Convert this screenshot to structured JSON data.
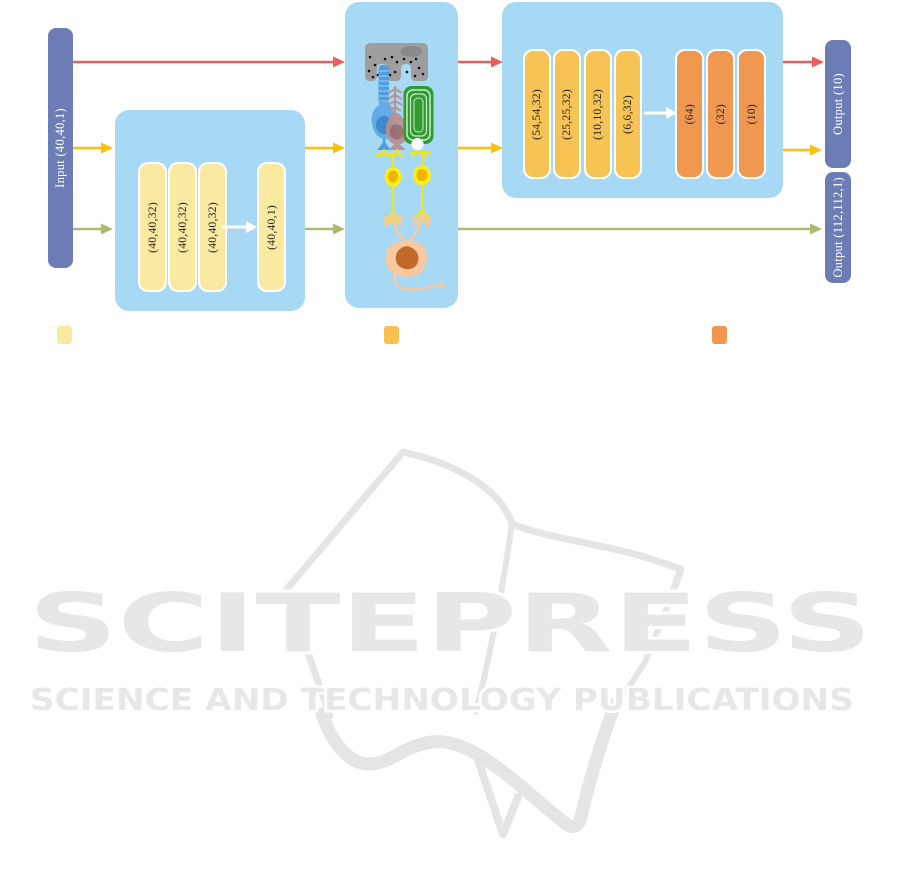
{
  "figure": {
    "type": "neural-network-architecture-diagram",
    "background": "#ffffff"
  },
  "diagram": {
    "input": {
      "label": "Input (40,40,1)"
    },
    "outputs": [
      {
        "label": "Output (10)"
      },
      {
        "label": "Output (112,112,1)"
      }
    ],
    "sae_branch": {
      "layers": [
        "(40,40,32)",
        "(40,40,32)",
        "(40,40,32)",
        "(40,40,1)"
      ]
    },
    "cnn_branch": {
      "conv_layers": [
        "(54,54,32)",
        "(25,25,32)",
        "(10,10,32)",
        "(6,6,32)"
      ],
      "dense_layers": [
        "(64)",
        "(32)",
        "(10)"
      ]
    },
    "colors": {
      "group_box": "#A7D9F5",
      "io_bar": "#6C7DB6",
      "layer_light_yellow": "#FAE9A1",
      "layer_amber": "#F8C355",
      "layer_orange": "#F0984F",
      "arrow_red": "#EC5C5C",
      "arrow_yellow": "#FDC00D",
      "arrow_olive": "#AEB96F",
      "arrow_white": "#FFFFFF"
    }
  },
  "legend": {
    "swatches": [
      {
        "name": "light-yellow-layer",
        "color": "#FAE9A1"
      },
      {
        "name": "amber-layer",
        "color": "#F9C14E"
      },
      {
        "name": "orange-layer",
        "color": "#F0964E"
      }
    ]
  },
  "watermark": {
    "logo": "SCITEPRESS",
    "tagline": "SCIENCE AND TECHNOLOGY PUBLICATIONS",
    "color": "#E7E7E7"
  }
}
